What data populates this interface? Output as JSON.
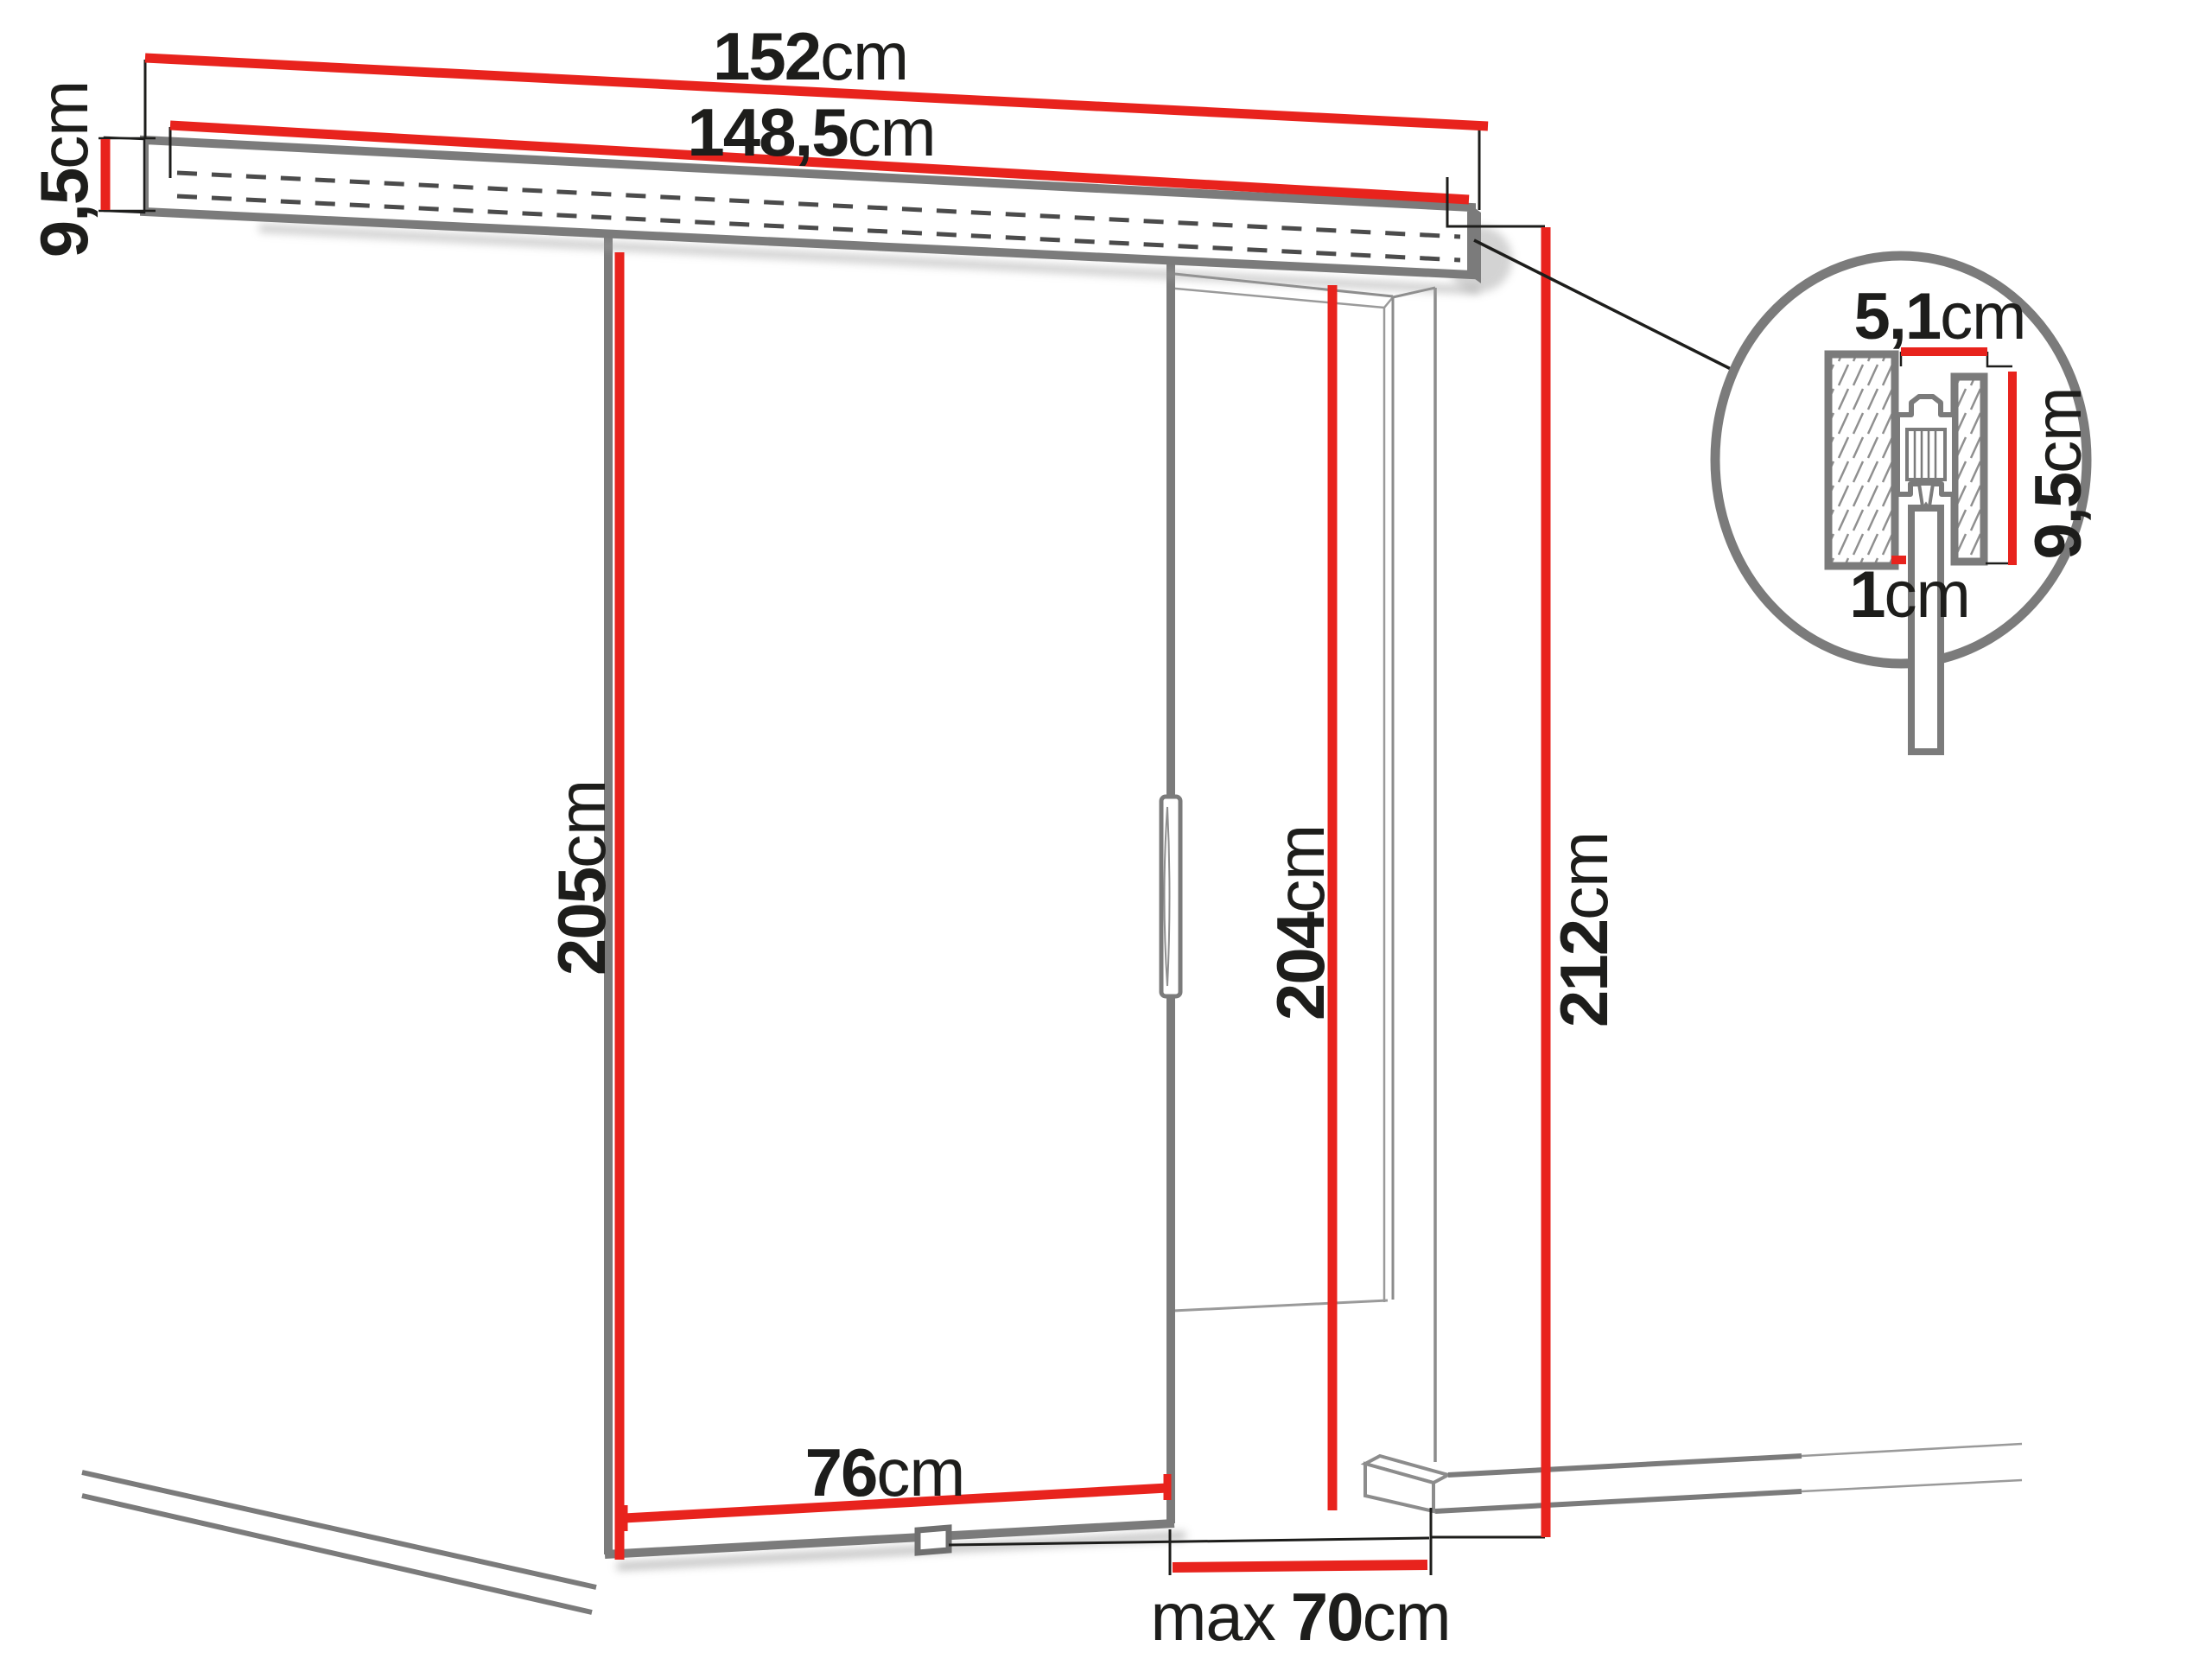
{
  "diagram": {
    "kind": "sliding-door-dimension-drawing",
    "colors": {
      "dimension_red": "#E8231D",
      "outline_gray": "#7B7B7B",
      "thin_line_gray": "#8C8C8C",
      "dashed_gray": "#4B4B4B",
      "text_black": "#1D1D1B"
    },
    "labels": {
      "track_width": {
        "value": "152",
        "unit": "cm"
      },
      "rail_width": {
        "value": "148,5",
        "unit": "cm"
      },
      "track_height": {
        "value": "9,5",
        "unit": "cm"
      },
      "door_height": {
        "value": "205",
        "unit": "cm"
      },
      "opening_height": {
        "value": "204",
        "unit": "cm"
      },
      "overall_height": {
        "value": "212",
        "unit": "cm"
      },
      "door_width": {
        "value": "76",
        "unit": "cm"
      },
      "max_passage_width": {
        "prefix": "max",
        "value": "70",
        "unit": "cm"
      },
      "detail_width": {
        "value": "5,1",
        "unit": "cm"
      },
      "detail_height": {
        "value": "9,5",
        "unit": "cm"
      },
      "detail_clearance": {
        "value": "1",
        "unit": "cm"
      }
    }
  }
}
